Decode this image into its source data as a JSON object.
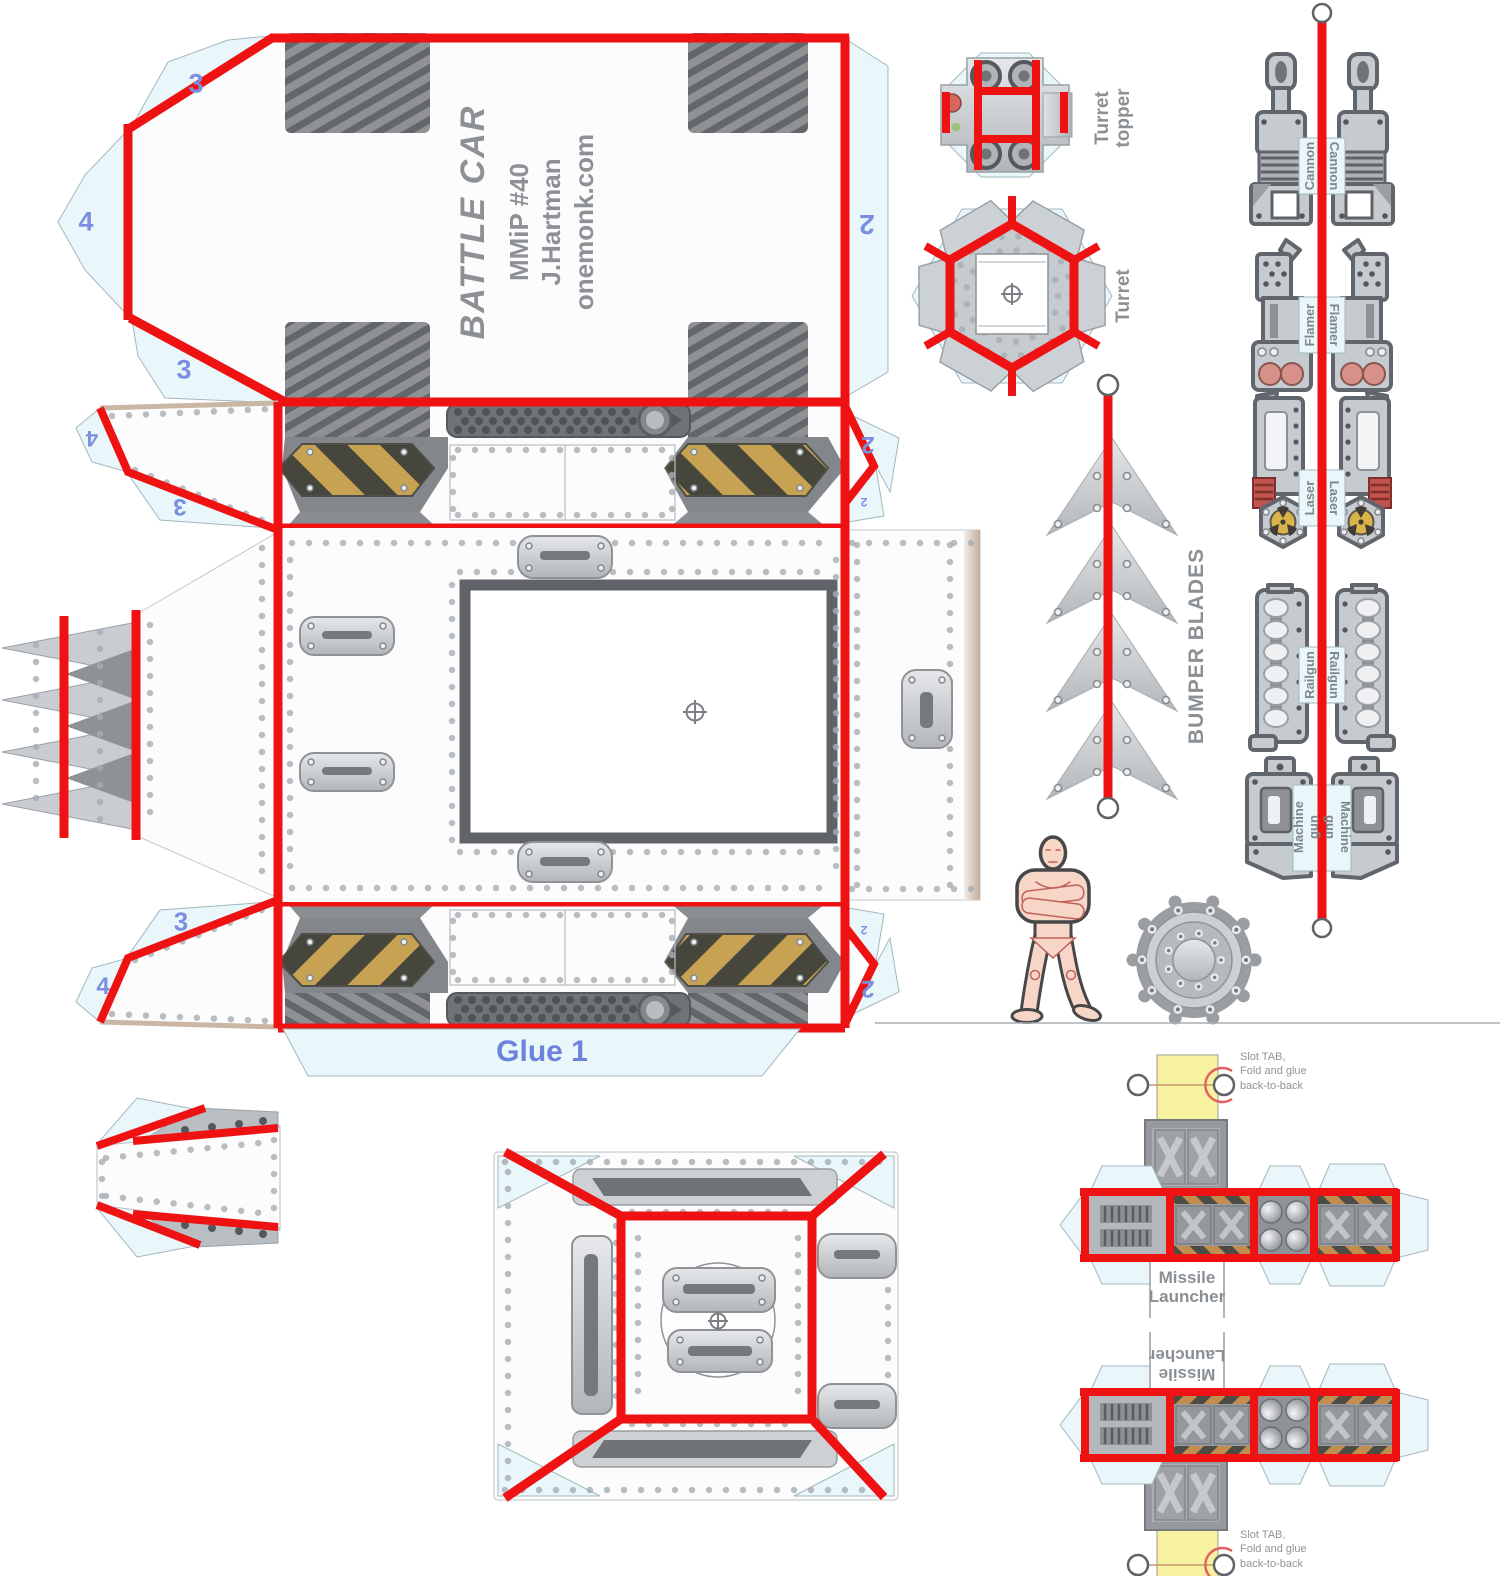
{
  "sheet": {
    "title": "BATTLE CAR",
    "model_number": "MMiP #40",
    "author": "J.Hartman",
    "website": "onemonk.com"
  },
  "labels": {
    "glue": "Glue 1",
    "turret_topper": "Turret topper",
    "turret": "Turret",
    "bumper_blades": "BUMPER BLADES",
    "missile_launcher": "Missile Launcher",
    "slot_tab_note": "Slot TAB,\nFold and glue\nback-to-back"
  },
  "weapons": [
    {
      "label": "Cannon"
    },
    {
      "label": "Flamer"
    },
    {
      "label": "Laser"
    },
    {
      "label": "Railgun"
    },
    {
      "label": "Machine gun"
    }
  ],
  "tab_numbers": {
    "roof_top_left": "3",
    "roof_left": "4",
    "roof_bottom_left": "3",
    "roof_right": "2",
    "upper_strip_left_top": "4",
    "upper_strip_left_bottom": "3",
    "upper_strip_right_main": "2",
    "upper_strip_right_small": "2",
    "lower_strip_left_top": "3",
    "lower_strip_left_bottom": "4",
    "lower_strip_right_main": "2",
    "lower_strip_right_small": "2"
  },
  "colors": {
    "fold_line": "#ee1212",
    "tab_fill": "#e9f6fa",
    "tab_number": "#7b8fe0",
    "glue_text": "#6b83dd",
    "label_gray": "#8b9095",
    "hazard_yellow": "#c7a252",
    "hazard_dark": "#46463c",
    "slot_tab_fill": "#f8f2a0"
  }
}
